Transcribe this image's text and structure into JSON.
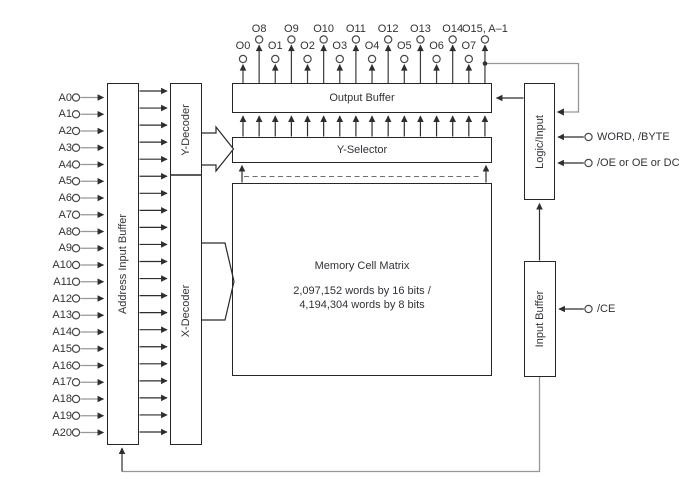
{
  "colors": {
    "background": "#ffffff",
    "line_dark": "#2e2e2e",
    "line_gray": "#979797",
    "box_border": "#262626",
    "text": "#32323a"
  },
  "blocks": {
    "address_input_buffer": "Address Input Buffer",
    "y_decoder": "Y-Decoder",
    "x_decoder": "X-Decoder",
    "output_buffer": "Output Buffer",
    "y_selector": "Y-Selector",
    "logic_input": "Logic/Input",
    "input_buffer": "Input Buffer",
    "memory_cell_matrix": {
      "title": "Memory Cell Matrix",
      "capacity_line1": "2,097,152 words by 16 bits /",
      "capacity_line2": "4,194,304 words by 8 bits"
    }
  },
  "address_inputs": [
    "A0",
    "A1",
    "A2",
    "A3",
    "A4",
    "A5",
    "A6",
    "A7",
    "A8",
    "A9",
    "A10",
    "A11",
    "A12",
    "A13",
    "A14",
    "A15",
    "A16",
    "A17",
    "A18",
    "A19",
    "A20"
  ],
  "output_terminals": [
    "O0",
    "O8",
    "O1",
    "O9",
    "O2",
    "O10",
    "O3",
    "O11",
    "O4",
    "O12",
    "O5",
    "O13",
    "O6",
    "O14",
    "O7",
    "O15, A–1"
  ],
  "control_inputs": {
    "word_byte": "WORD, /BYTE",
    "oe": "/OE or OE or DC",
    "ce": "/CE"
  }
}
